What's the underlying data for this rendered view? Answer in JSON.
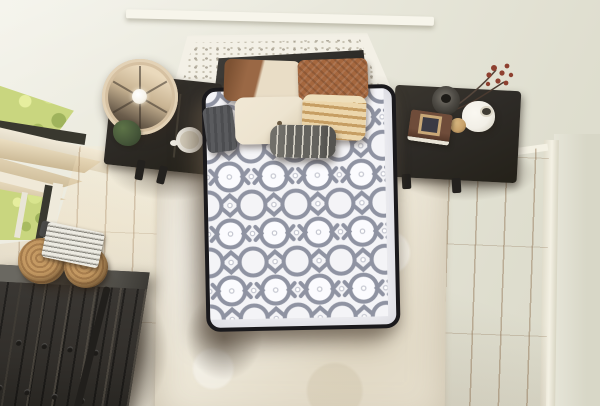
{
  "meta": {
    "type": "product-lifestyle-photograph",
    "description": "Top-down view of a bedroom: white quilted mattress with black binding on a bed flanked by two dark nightstands, white carved headboard panel, throw pillows, shag rug, wood floor, curved-front black dresser, baskets, window with greenery and beige curtain"
  },
  "colors": {
    "wall": "#e9e8dc",
    "wall_right": "#d8d7c7",
    "baseboard": "#f4f1e4",
    "trim": "#f7f5eb",
    "floor": "#c49c6e",
    "floor_light": "#d4b286",
    "rug": "#ece6d6",
    "mattress_top": "#f3f3f6",
    "quilt_line": "#8f93a2",
    "binding": "#1a191c",
    "headboard": "#f3f0e6",
    "cushion": "#3e3c38",
    "nightstand": "#2e2b27",
    "dresser": "#322f2b",
    "lamp_shade": "#d6c1a2",
    "lamp_inner_dark": "#6b5d4c",
    "bulb": "#f7f3e9",
    "plant": "#47583a",
    "mug": "#efece3",
    "curtain": "#e2d3b4",
    "curtain_deep": "#c9b692",
    "window_green": "#c9d67f",
    "window_frame": "#39382f",
    "sill": "#f0e9d8",
    "pillow_leather": "#9a6845",
    "pillow_cream": "#e9ddc6",
    "pillow_rust": "#a5673e",
    "pillow_ivory": "#ede4d0",
    "stripe_light": "#ecd6ab",
    "stripe_dark": "#c69e63",
    "lumbar": "#64635e",
    "lumbar_stripe": "#dad6ca",
    "gray_knit": "#5a5b5e",
    "basket": "#c59a63",
    "basket_dark": "#a87e4e",
    "magazine": "#eceae2",
    "book": "#6f4c3a",
    "berry": "#8e4030",
    "wood_ball": "#c8a26b",
    "jar": "#f2efe7",
    "vase_dark": "#4e4b45"
  },
  "scene": {
    "objects": [
      "quilted-mattress",
      "carved-headboard-panel",
      "headboard-cushion",
      "colorblock-leather-pillow",
      "woven-rust-pillow",
      "ivory-pillow",
      "striped-tan-pillow",
      "gray-knit-pillow",
      "gray-striped-lumbar-pillow",
      "left-nightstand",
      "drum-lamp",
      "potted-plant",
      "white-mug",
      "right-nightstand",
      "berry-stem-vase",
      "white-jar",
      "wooden-sphere",
      "book-stack-with-frame",
      "curved-front-dresser",
      "woven-baskets",
      "magazine-stack",
      "shag-rug",
      "wood-plank-floor",
      "window-with-greenery",
      "draped-curtain",
      "wall-trim-ledge"
    ]
  }
}
